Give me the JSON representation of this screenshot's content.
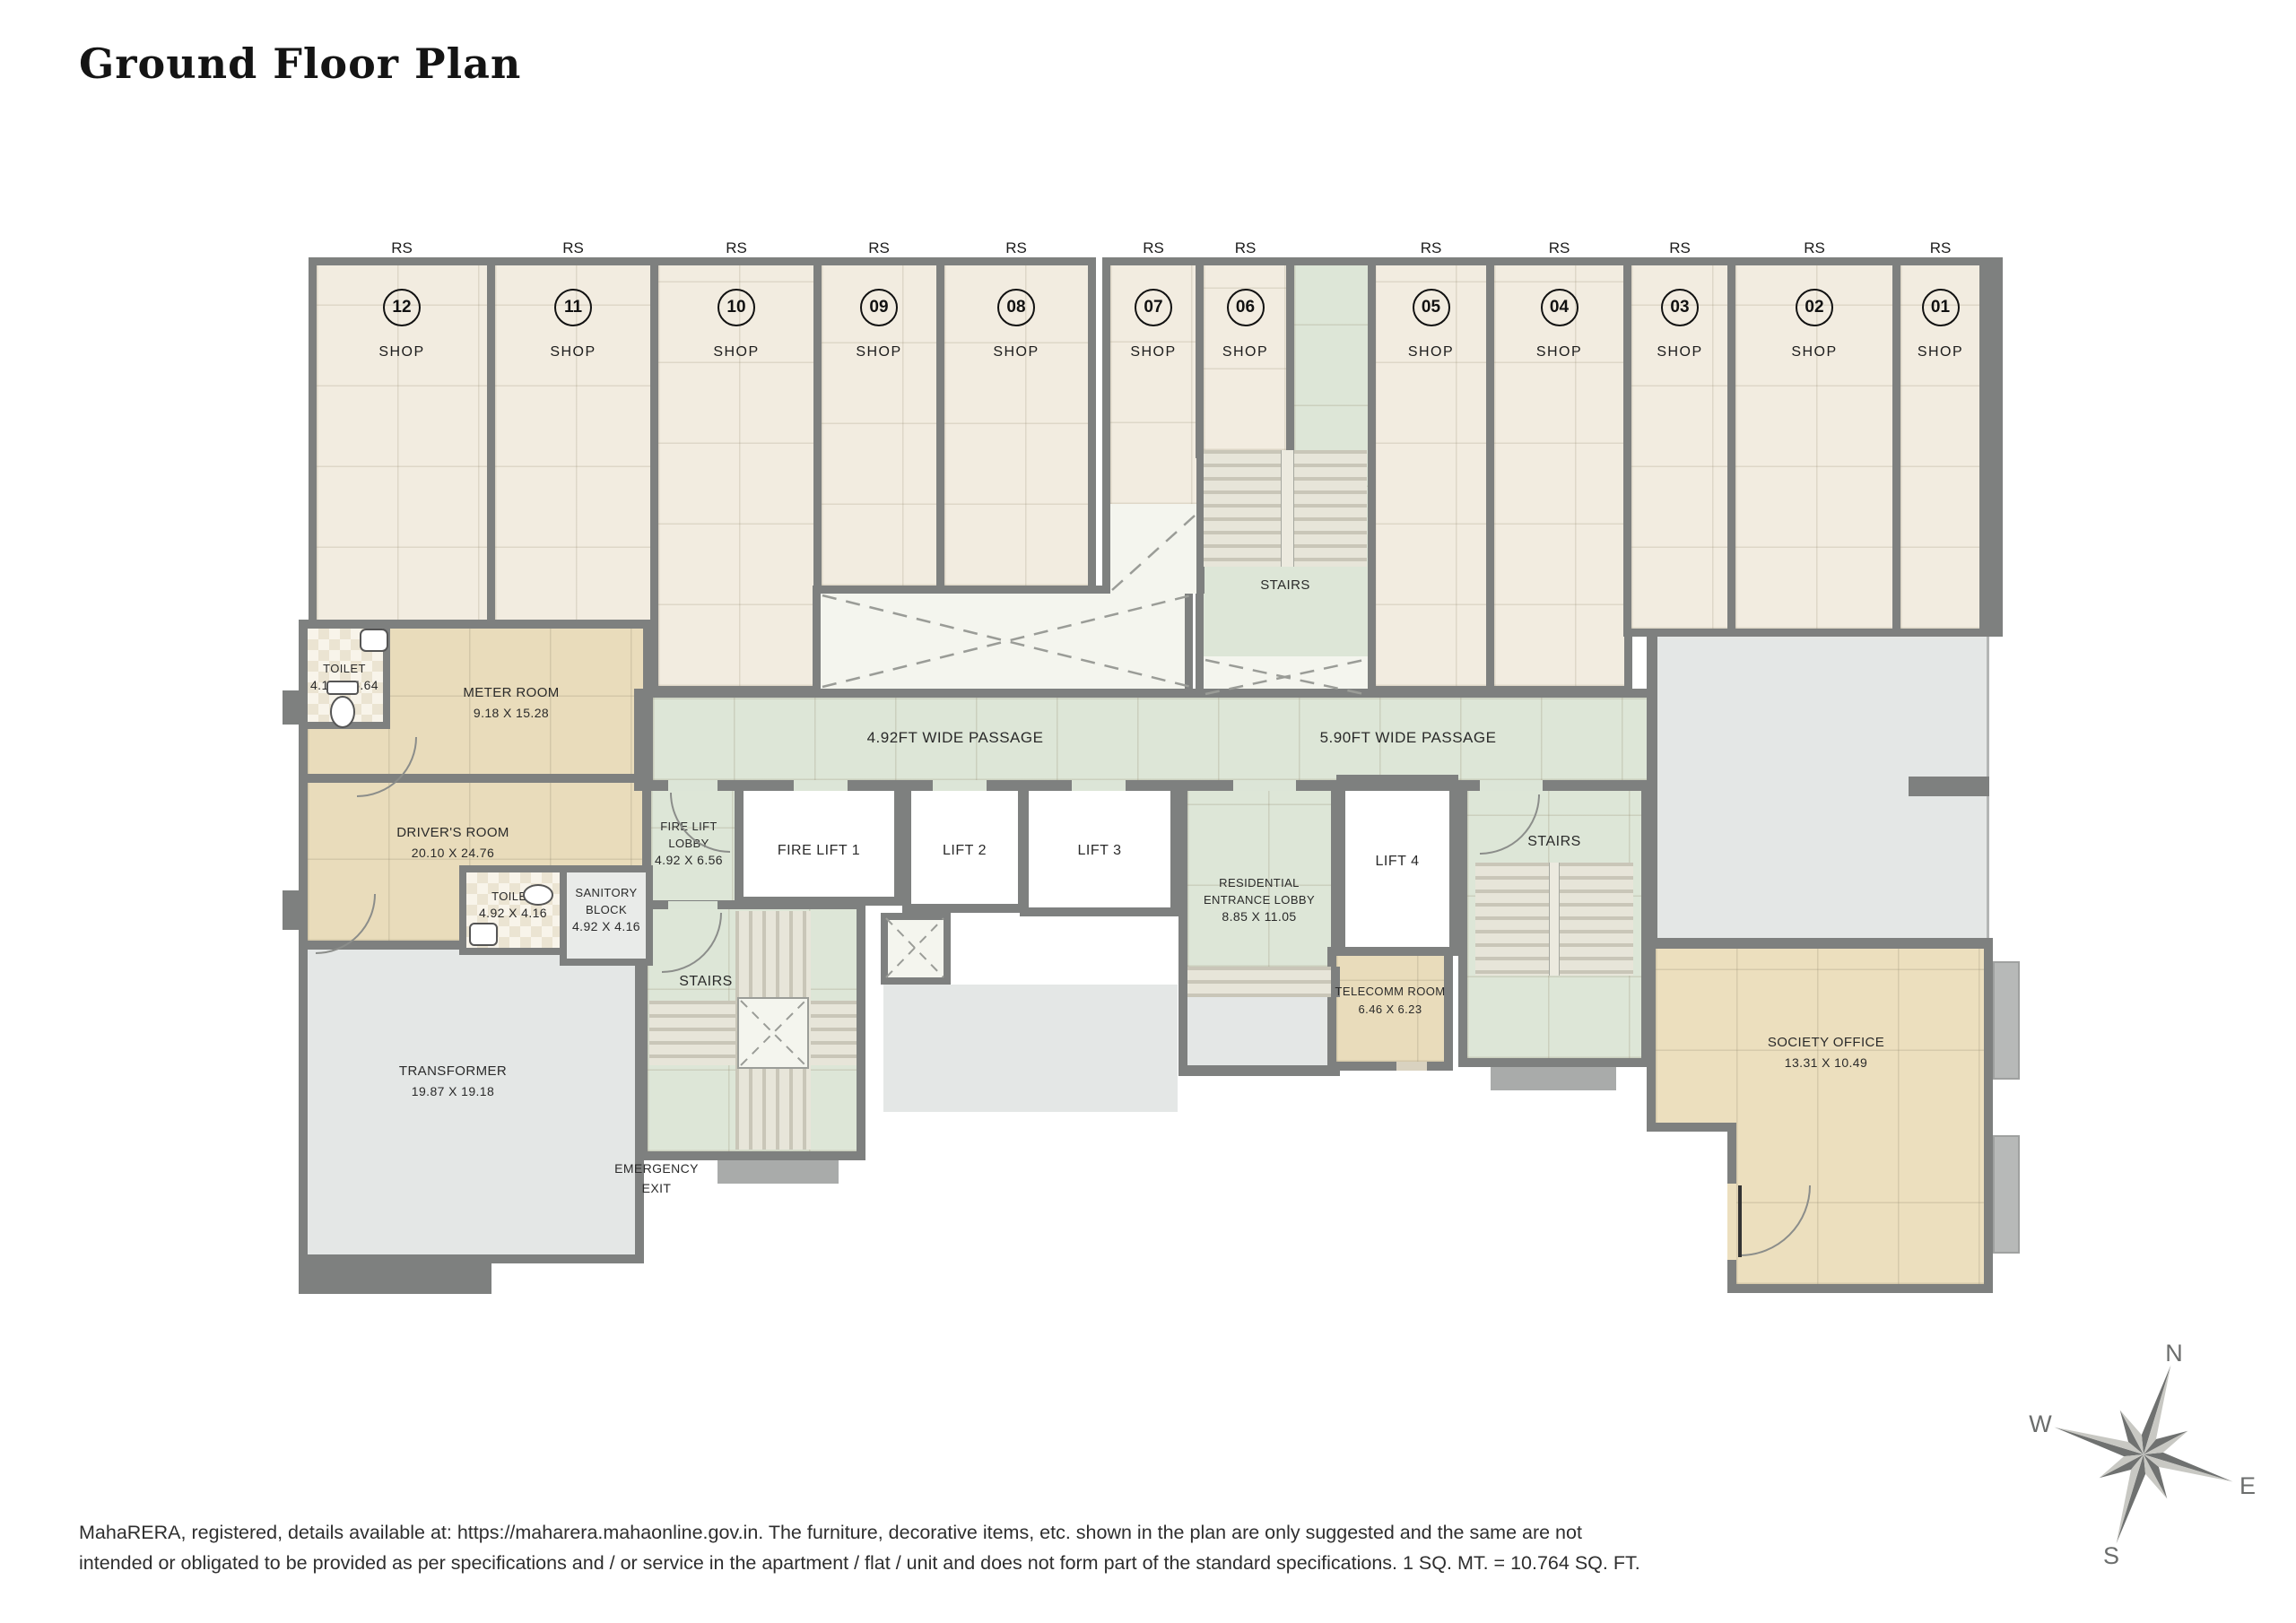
{
  "title": "Ground Floor Plan",
  "shops": [
    {
      "rs": "RS",
      "num": "12",
      "label": "SHOP"
    },
    {
      "rs": "RS",
      "num": "11",
      "label": "SHOP"
    },
    {
      "rs": "RS",
      "num": "10",
      "label": "SHOP"
    },
    {
      "rs": "RS",
      "num": "09",
      "label": "SHOP"
    },
    {
      "rs": "RS",
      "num": "08",
      "label": "SHOP"
    },
    {
      "rs": "RS",
      "num": "07",
      "label": "SHOP"
    },
    {
      "rs": "RS",
      "num": "06",
      "label": "SHOP"
    },
    {
      "rs": "RS",
      "num": "05",
      "label": "SHOP"
    },
    {
      "rs": "RS",
      "num": "04",
      "label": "SHOP"
    },
    {
      "rs": "RS",
      "num": "03",
      "label": "SHOP"
    },
    {
      "rs": "RS",
      "num": "02",
      "label": "SHOP"
    },
    {
      "rs": "RS",
      "num": "01",
      "label": "SHOP"
    }
  ],
  "passages": {
    "p1": "4.92FT WIDE PASSAGE",
    "p2": "5.90FT WIDE PASSAGE"
  },
  "rooms": {
    "toilet1": {
      "name": "TOILET",
      "dims": "4.10 X 5.64"
    },
    "meter": {
      "name": "METER ROOM",
      "dims": "9.18 X 15.28"
    },
    "drivers": {
      "name": "DRIVER'S ROOM",
      "dims": "20.10 X 24.76"
    },
    "toilet2": {
      "name": "TOILET",
      "dims": "4.92 X 4.16"
    },
    "sanitory": {
      "name1": "SANITORY",
      "name2": "BLOCK",
      "dims": "4.92 X 4.16"
    },
    "transformer": {
      "name": "TRANSFORMER",
      "dims": "19.87 X 19.18"
    },
    "fire_lift_lobby": {
      "name1": "FIRE LIFT",
      "name2": "LOBBY",
      "dims": "4.92 X 6.56"
    },
    "fire_lift_1": {
      "name": "FIRE LIFT 1"
    },
    "lift_2": {
      "name": "LIFT 2"
    },
    "lift_3": {
      "name": "LIFT 3"
    },
    "lift_4": {
      "name": "LIFT 4"
    },
    "residential_lobby": {
      "name1": "RESIDENTIAL",
      "name2": "ENTRANCE LOBBY",
      "dims": "8.85 X 11.05"
    },
    "telecomm": {
      "name": "TELECOMM ROOM",
      "dims": "6.46 X 6.23"
    },
    "society": {
      "name": "SOCIETY OFFICE",
      "dims": "13.31 X 10.49"
    },
    "stairs_mid": {
      "name": "STAIRS"
    },
    "stairs_left": {
      "name": "STAIRS"
    },
    "stairs_right": {
      "name": "STAIRS"
    },
    "emergency_exit": {
      "line1": "EMERGENCY",
      "line2": "EXIT"
    }
  },
  "compass": {
    "n": "N",
    "e": "E",
    "s": "S",
    "w": "W"
  },
  "footer": {
    "line1": "MahaRERA, registered, details available at: https://maharera.mahaonline.gov.in. The furniture, decorative items, etc. shown in the plan are only suggested and the same are not",
    "line2": "intended or obligated to be provided as per specifications and / or service in the apartment / flat / unit and does not form part of the standard specifications. 1 SQ. MT. = 10.764 SQ. FT."
  },
  "colors": {
    "wall": "#7e807f",
    "shop_fill": "#f2ece0",
    "passage_green": "#dde6d7",
    "room_tan": "#e9dcbb",
    "open_gray": "#e4e7e6",
    "hatch_white": "#f4f5ee"
  }
}
